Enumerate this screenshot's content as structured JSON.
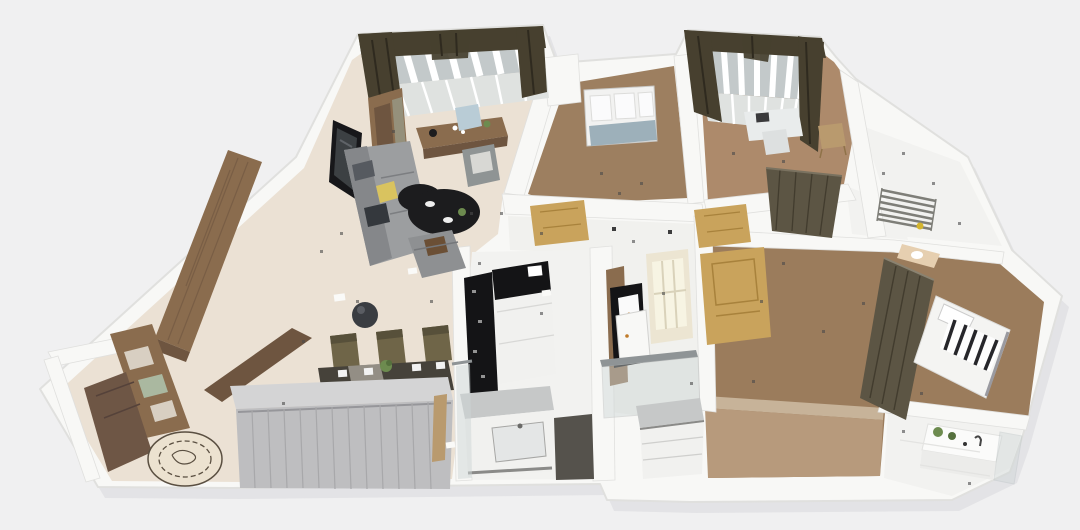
{
  "scene": {
    "name": "3D apartment floor plan render, isometric overview",
    "view": "isometric-3d-floorplan",
    "has_text": false
  },
  "colors": {
    "background": "#f0f0f1",
    "slabShadow": "#d9d9dd",
    "wall": "#f8f8f6",
    "wallEdge": "#e0e0de",
    "wallDot": "#3c3c3c",
    "floorCream": "#ebe1d4",
    "floorWoodStudy": "#9d7f60",
    "floorWoodBed2": "#ad8a6b",
    "floorWoodBed3": "#9b7c5c",
    "floorWoodBed3Light": "#b79a7c",
    "floorPale": "#d6c6ae",
    "floorWhite": "#f2f2f0",
    "hallFloor": "#f1f1ee",
    "floorDarkBand": "#55524c",
    "curtain": "#47402f",
    "curtainDark": "#2f2a1f",
    "windowGlass": "#c3c9ca",
    "latticeGray": "#dfe2e0",
    "windowSlat": "#ffffff",
    "glassBlue": "#9db0ba",
    "wood": "#8a6c4e",
    "woodDark": "#6e5540",
    "woodLight": "#b99a6e",
    "tvBlack": "#17171a",
    "screen": "#3c4043",
    "sofa": "#9c9ea0",
    "sofaDark": "#85878a",
    "pillowYellow": "#d9c35f",
    "pillowDark": "#34383d",
    "pillowGray": "#565a60",
    "tableBlack": "#1c1c1e",
    "chairOlive": "#6f6548",
    "chairOliveDark": "#57503a",
    "tableTopDark": "#46423a",
    "runnerGray": "#9b978e",
    "doorTan": "#c9a35c",
    "doorTanDark": "#a8823c",
    "doorBrown": "#6e5645",
    "grayTop": "#d4d4d5",
    "grayFront": "#bebec0",
    "slatLine": "#a8a8aa",
    "applianceBlack": "#141416",
    "applianceWhite": "#f1f1ef",
    "counterGray": "#c6c8c8",
    "steel": "#8f9496",
    "glassTint": "#cdd5d5",
    "oliveWardrobe": "#5c5544",
    "oliveWardrobeDark": "#423c2e",
    "rackGray": "#7e7e78",
    "duckYellow": "#d4b52f",
    "counterBeige": "#e6cfb0",
    "fixtureDark": "#474233",
    "bedWhite": "#f4f4f2",
    "stripeDark": "#26262a",
    "vanityWhite": "#fbfbfa",
    "plantGreen": "#6d8b4f",
    "plantDark": "#55703d",
    "rugBase": "#ece2d0",
    "rugLine": "#5a4f41",
    "speckle": "#4a4a4a",
    "paper": "#fafaf8",
    "blueChair": "#b9ccd6",
    "chairGray": "#8f9494",
    "armchair": "#8e9092",
    "blanketBrown": "#6b4f35",
    "lampDark": "#3a3d42",
    "deskWhite": "#e9ecec",
    "chairWhite": "#dde0e0",
    "sinkWhite": "#e4e6e6",
    "mullion": "#d9d2ba",
    "frameCream": "#ece5d2",
    "glassCream": "#f7f4e3"
  },
  "rooms": [
    {
      "id": "living-room",
      "floor": "cream-tile",
      "contents": [
        "bay-window-with-dark-curtains",
        "bookcase",
        "wall-tv",
        "writing-desk",
        "blue-chair",
        "gray-chair",
        "gray-sofa",
        "yellow-pillow",
        "dark-pillows",
        "black-round-coffee-table",
        "armchair",
        "pendant-lamp"
      ]
    },
    {
      "id": "dining-area",
      "floor": "cream-tile",
      "contents": [
        "dining-table",
        "olive-dining-chairs",
        "white-plates",
        "plant-centerpiece"
      ]
    },
    {
      "id": "entry",
      "floor": "cream-tile",
      "contents": [
        "front-door",
        "round-patterned-rug",
        "wood-partition-shelf",
        "wood-beam",
        "tall-wood-wardrobe",
        "gray-sliding-wardrobe"
      ]
    },
    {
      "id": "kitchen",
      "floor": "white-tile",
      "contents": [
        "black-tall-unit",
        "fridge-cabinet",
        "counter-with-sink",
        "dark-floor-band",
        "glass-partition"
      ]
    },
    {
      "id": "hallway",
      "floor": "white-tile",
      "contents": [
        "tan-door-left",
        "tan-door-right",
        "glazed-door",
        "bedroom-door",
        "brown-cabinet",
        "black-oven-column",
        "white-fridge",
        "shoe-cabinet",
        "glass-balustrade"
      ]
    },
    {
      "id": "study",
      "floor": "wood",
      "contents": [
        "window-with-blue-pane"
      ]
    },
    {
      "id": "bedroom-top",
      "floor": "wood",
      "contents": [
        "bay-window-with-dark-curtains",
        "white-desk",
        "white-chair",
        "wood-chair",
        "dark-wardrobe"
      ]
    },
    {
      "id": "balcony",
      "floor": "white-tile",
      "contents": [
        "drying-rack",
        "yellow-duck"
      ]
    },
    {
      "id": "bathroom-small",
      "floor": "white-tile",
      "contents": [
        "beige-counter",
        "sink",
        "dark-fixture"
      ]
    },
    {
      "id": "bedroom-right",
      "floor": "wood",
      "contents": [
        "dark-wardrobe",
        "white-bed",
        "striped-throw",
        "pillow"
      ]
    },
    {
      "id": "bathroom",
      "floor": "white-tile",
      "contents": [
        "white-vanity",
        "potted-plants",
        "faucet",
        "shower-glass"
      ]
    }
  ]
}
